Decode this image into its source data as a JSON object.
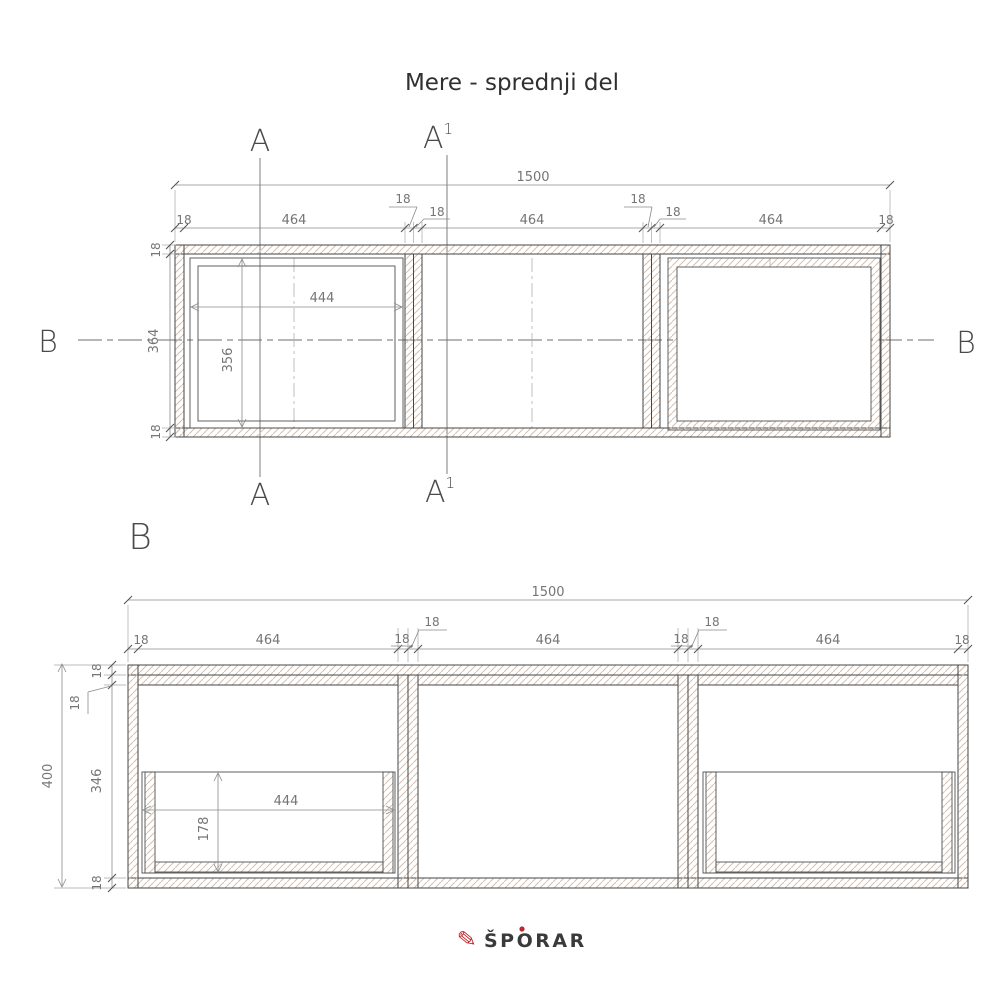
{
  "title": "Mere - sprednji del",
  "section_labels": {
    "a": "A",
    "a1_base": "A",
    "a1_sup": "1",
    "b": "B",
    "b_view": "B"
  },
  "front_view": {
    "total": "1500",
    "t1": "18",
    "w1": "464",
    "t2": "18",
    "t3": "18",
    "w2": "464",
    "t4": "18",
    "t5": "18",
    "w3": "464",
    "t6": "18",
    "left_top": "18",
    "left_mid": "364",
    "left_bottom": "18",
    "inner_width": "444",
    "inner_height": "356"
  },
  "section_view": {
    "total": "1500",
    "t1": "18",
    "w1": "464",
    "t2": "18",
    "t3": "18",
    "w2": "464",
    "t4": "18",
    "t5": "18",
    "w3": "464",
    "t6": "18",
    "depth_total": "400",
    "v1": "18",
    "v2": "18",
    "v3": "346",
    "v4": "18",
    "drawer_width": "444",
    "drawer_height": "178"
  },
  "logo": {
    "text": "ŠPORAR"
  },
  "colors": {
    "accent_red": "#c0272d",
    "line_dark": "#454545",
    "hatch": "#d4bfae",
    "dim": "#8a8a8a"
  }
}
